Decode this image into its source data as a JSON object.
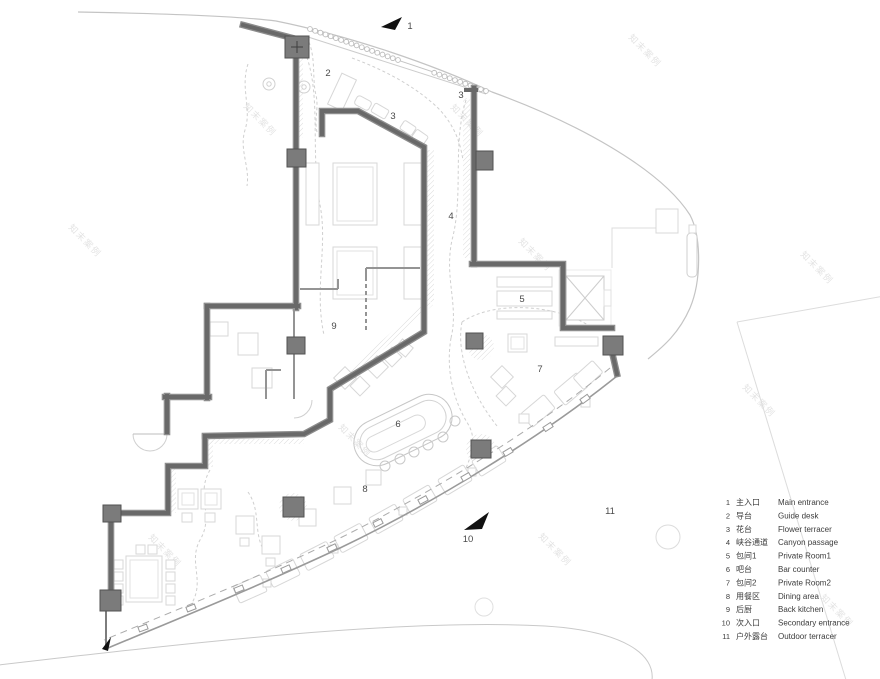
{
  "watermark": {
    "text": "知末案例"
  },
  "plan_labels": [
    {
      "id": "1",
      "text": "1"
    },
    {
      "id": "2",
      "text": "2"
    },
    {
      "id": "3a",
      "text": "3"
    },
    {
      "id": "3b",
      "text": "3"
    },
    {
      "id": "4",
      "text": "4"
    },
    {
      "id": "5",
      "text": "5"
    },
    {
      "id": "6",
      "text": "6"
    },
    {
      "id": "7",
      "text": "7"
    },
    {
      "id": "8",
      "text": "8"
    },
    {
      "id": "9",
      "text": "9"
    },
    {
      "id": "10",
      "text": "10"
    },
    {
      "id": "11",
      "text": "11"
    }
  ],
  "legend": {
    "items": [
      {
        "num": "1",
        "zh": "主入口",
        "en": "Main entrance"
      },
      {
        "num": "2",
        "zh": "导台",
        "en": "Guide desk"
      },
      {
        "num": "3",
        "zh": "花台",
        "en": "Flower terracer"
      },
      {
        "num": "4",
        "zh": "峡谷通道",
        "en": "Canyon passage"
      },
      {
        "num": "5",
        "zh": "包间1",
        "en": "Private Room1"
      },
      {
        "num": "6",
        "zh": "吧台",
        "en": "Bar counter"
      },
      {
        "num": "7",
        "zh": "包间2",
        "en": "Private Room2"
      },
      {
        "num": "8",
        "zh": "用餐区",
        "en": "Dining area"
      },
      {
        "num": "9",
        "zh": "后厨",
        "en": "Back kitchen"
      },
      {
        "num": "10",
        "zh": "次入口",
        "en": "Secondary entrance"
      },
      {
        "num": "11",
        "zh": "户外露台",
        "en": "Outdoor terracer"
      }
    ]
  },
  "colors": {
    "wall_core": "#696969",
    "wall_edge": "#8d8d8d",
    "column_fill": "#7b7b7b",
    "light_outline": "#d7d7d7",
    "site_line": "#c4c4c4",
    "arrow": "#111111"
  }
}
